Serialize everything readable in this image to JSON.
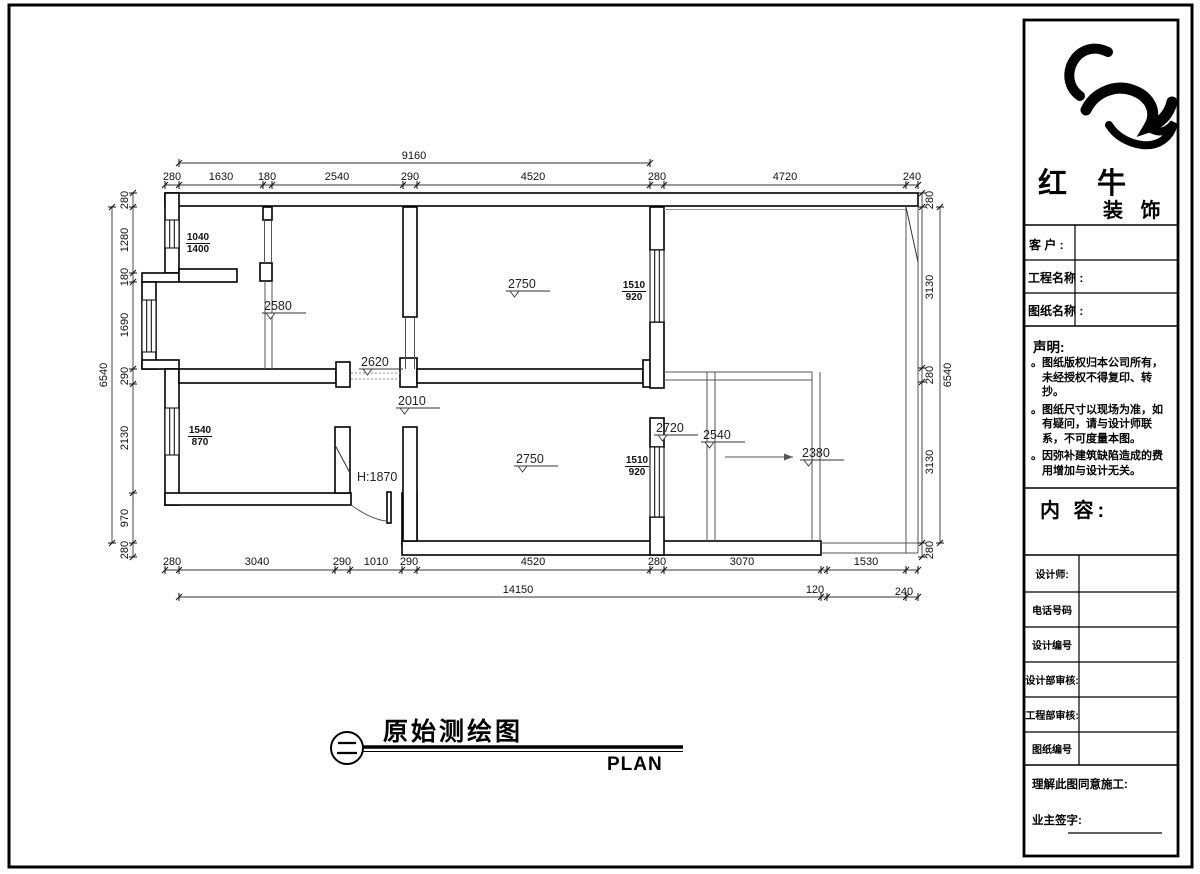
{
  "sheet": {
    "plan_title": "原始测绘图",
    "plan_subtitle": "PLAN"
  },
  "brand": {
    "main": "红 牛",
    "sub": "装 饰"
  },
  "title_block": {
    "customer_label": "客 户 :",
    "project_label": "工程名称 :",
    "drawing_label": "图纸名称 :",
    "statement_heading": "声明:",
    "bullet": "。",
    "statement_items": [
      "图纸版权归本公司所有，未经授权不得复印、转抄。",
      "图纸尺寸以现场为准，如有疑问，请与设计师联系，不可度量本图。",
      "因弥补建筑缺陷造成的费用增加与设计无关。"
    ],
    "content_label": "内 容:",
    "rows": [
      {
        "label": "设计师:"
      },
      {
        "label": "电话号码"
      },
      {
        "label": "设计编号"
      },
      {
        "label": "设计部审核:"
      },
      {
        "label": "工程部审核:"
      },
      {
        "label": "图纸编号"
      }
    ],
    "agree_label": "理解此图同意施工:",
    "sign_label": "业主签字:"
  },
  "dims": {
    "top_overall": "9160",
    "top_chain": [
      "280",
      "1630",
      "180",
      "2540",
      "290",
      "4520",
      "280",
      "4720",
      "240"
    ],
    "left_overall": "6540",
    "left_chain": [
      "280",
      "1280",
      "180",
      "1690",
      "290",
      "2130",
      "970",
      "280"
    ],
    "right_chain": [
      "280",
      "3130",
      "280",
      "3130",
      "280"
    ],
    "right_overall": "6540",
    "bottom_chain": [
      "280",
      "3040",
      "290",
      "1010",
      "290",
      "4520",
      "280",
      "3070",
      "1530"
    ],
    "bottom_overall": "14150",
    "bottom_extra": [
      "120",
      "240"
    ]
  },
  "annotations": {
    "ceiling_heights": [
      "2580",
      "2620",
      "2010",
      "2750",
      "2750",
      "2720",
      "2540",
      "2380"
    ],
    "door_height": "H:1870",
    "windows": [
      {
        "top": "1040",
        "bottom": "1400"
      },
      {
        "top": "1540",
        "bottom": "870"
      },
      {
        "top": "1510",
        "bottom": "920"
      },
      {
        "top": "1510",
        "bottom": "920"
      }
    ]
  }
}
